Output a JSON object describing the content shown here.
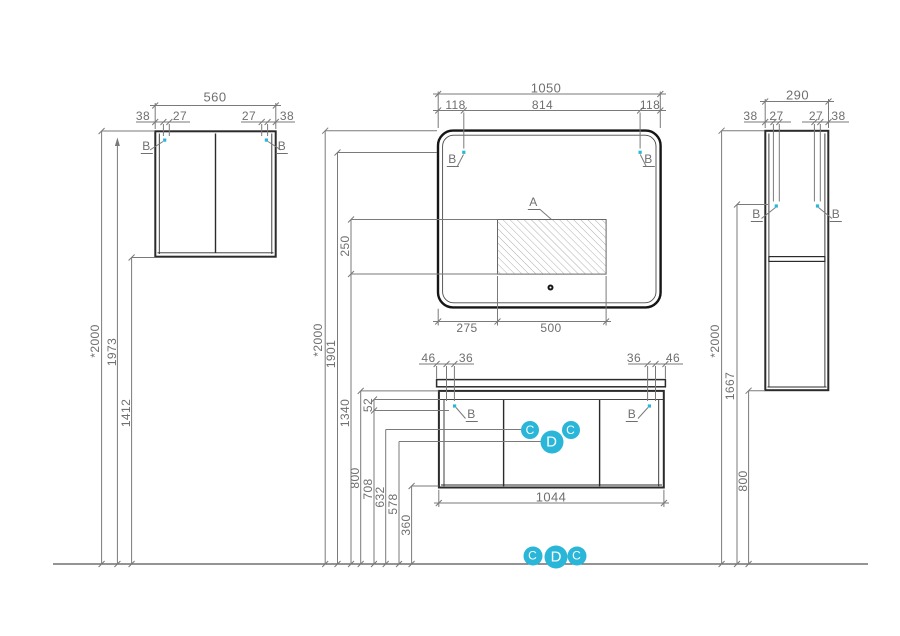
{
  "drawing": {
    "section_labels": {
      "a": "A",
      "b": "B",
      "c": "C",
      "d": "D"
    },
    "colors": {
      "marker": "#29b6d8",
      "outline": "#2b2b2b",
      "dim_line": "#777777",
      "text": "#6f6f6f"
    },
    "wall_cabinet": {
      "width": "560",
      "offsets": [
        "38",
        "27",
        "27",
        "38"
      ]
    },
    "mirror": {
      "width": "1050",
      "top_offsets": [
        "118",
        "814",
        "118"
      ],
      "bottom_offsets": [
        "275",
        "500"
      ]
    },
    "tall_cabinet": {
      "width": "290",
      "offsets": [
        "38",
        "27",
        "27",
        "38"
      ]
    },
    "vanity": {
      "width": "1044",
      "offsets": [
        "46",
        "36",
        "36",
        "46"
      ],
      "hinge_drop": "52"
    },
    "heights_left": [
      "*2000",
      "1973",
      "1412"
    ],
    "heights_middle": [
      "*2000",
      "1901",
      "250",
      "1340",
      "800",
      "708",
      "632",
      "578",
      "360"
    ],
    "heights_right": [
      "*2000",
      "1667",
      "800"
    ]
  }
}
